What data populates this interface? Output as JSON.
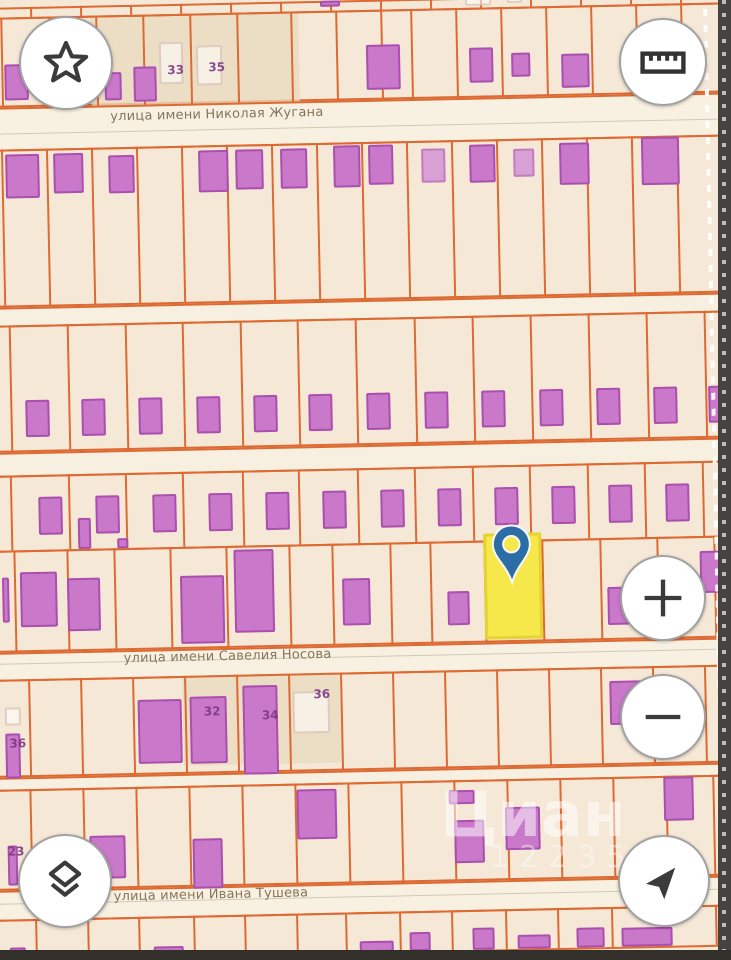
{
  "watermark": {
    "text": "Циан",
    "sub": "12235"
  },
  "controls": {
    "favorites": "star-icon",
    "measure": "ruler-icon",
    "zoom_in": "plus-icon",
    "zoom_out": "minus-icon",
    "layers": "layers-icon",
    "locate": "navigation-arrow-icon"
  },
  "map": {
    "colors": {
      "background": "#f5e8d7",
      "street_band": "#f8f1e2",
      "parcel_line": "#dd6a33",
      "building_fill": "#c978ca",
      "building_outline": "#aa4fae",
      "highlight_fill": "#f6e84b",
      "pin_blue": "#2d6da5",
      "tan_patch": "#e8d9bf"
    },
    "streets": [
      {
        "name": "улица имени Николая Жугана",
        "band_top": 100,
        "band_bottom": 142,
        "label_x": 118,
        "label_y": 104
      },
      {
        "name": "улица имени Савелия Носова",
        "band_top": 645,
        "band_bottom": 672,
        "label_x": 120,
        "label_y": 646
      },
      {
        "name": "улица имени Ивана Тушева",
        "band_top": 883,
        "band_bottom": 912,
        "label_x": 105,
        "label_y": 884
      }
    ],
    "lanes": [
      {
        "top": 300,
        "bottom": 318
      },
      {
        "top": 445,
        "bottom": 468
      },
      {
        "top": 770,
        "bottom": 782
      }
    ],
    "rows": [
      {
        "top": 0,
        "bottom": 10,
        "lines": [
          40,
          90,
          140,
          190,
          240,
          290,
          340,
          390,
          440,
          490,
          540,
          590,
          640,
          690
        ]
      },
      {
        "top": 10,
        "bottom": 100,
        "lines": [
          10,
          58,
          105,
          152,
          199,
          246,
          300,
          345,
          390,
          420,
          465,
          510,
          555,
          600,
          645,
          690
        ]
      },
      {
        "top": 142,
        "bottom": 300,
        "lines": [
          8,
          53,
          98,
          143,
          188,
          233,
          278,
          323,
          368,
          413,
          458,
          503,
          548,
          593,
          638,
          683
        ]
      },
      {
        "top": 318,
        "bottom": 445,
        "lines": [
          12,
          70,
          128,
          185,
          243,
          300,
          358,
          417,
          475,
          533,
          591,
          649,
          707
        ]
      },
      {
        "top": 468,
        "bottom": 543,
        "lines": [
          10,
          68,
          125,
          182,
          242,
          298,
          357,
          414,
          472,
          529,
          587,
          644,
          702
        ]
      },
      {
        "top": 543,
        "bottom": 645,
        "lines": [
          12,
          65,
          112,
          168,
          224,
          287,
          330,
          388,
          428,
          482,
          540,
          598,
          655,
          712
        ]
      },
      {
        "top": 672,
        "bottom": 770,
        "lines": [
          24,
          76,
          128,
          180,
          232,
          284,
          336,
          388,
          440,
          492,
          544,
          596,
          648,
          700
        ]
      },
      {
        "top": 782,
        "bottom": 883,
        "lines": [
          23,
          76,
          129,
          182,
          235,
          288,
          341,
          394,
          447,
          500,
          553,
          606,
          659,
          706
        ]
      },
      {
        "top": 912,
        "bottom": 952,
        "lines": [
          26,
          78,
          129,
          184,
          235,
          287,
          336,
          390,
          442,
          496,
          548,
          602,
          654,
          706
        ]
      }
    ],
    "patches": [
      {
        "x": 100,
        "y": 10,
        "w": 208,
        "h": 90
      },
      {
        "x": 178,
        "y": 672,
        "w": 158,
        "h": 90
      }
    ],
    "buildings": [
      [
        330,
        0,
        20,
        6,
        "s"
      ],
      [
        475,
        0,
        26,
        8,
        "g"
      ],
      [
        517,
        0,
        15,
        6,
        "g"
      ],
      [
        13,
        57,
        24,
        36,
        "s"
      ],
      [
        78,
        52,
        22,
        45,
        "s"
      ],
      [
        113,
        67,
        17,
        28,
        "s"
      ],
      [
        142,
        62,
        23,
        35,
        "s"
      ],
      [
        168,
        38,
        24,
        42,
        "g"
      ],
      [
        205,
        42,
        26,
        40,
        "g"
      ],
      [
        375,
        45,
        34,
        45,
        "s"
      ],
      [
        478,
        50,
        24,
        35,
        "s"
      ],
      [
        520,
        56,
        19,
        24,
        "s"
      ],
      [
        570,
        58,
        28,
        34,
        "s"
      ],
      [
        650,
        42,
        33,
        46,
        "s"
      ],
      [
        12,
        147,
        34,
        44,
        "s"
      ],
      [
        60,
        147,
        30,
        40,
        "s"
      ],
      [
        115,
        150,
        26,
        38,
        "s"
      ],
      [
        205,
        147,
        30,
        42,
        "s"
      ],
      [
        242,
        147,
        28,
        40,
        "s"
      ],
      [
        287,
        147,
        27,
        40,
        "s"
      ],
      [
        340,
        145,
        27,
        42,
        "s"
      ],
      [
        375,
        145,
        25,
        40,
        "s"
      ],
      [
        428,
        150,
        24,
        34,
        "l"
      ],
      [
        476,
        147,
        26,
        38,
        "s"
      ],
      [
        520,
        152,
        21,
        28,
        "l"
      ],
      [
        566,
        147,
        30,
        42,
        "s"
      ],
      [
        648,
        143,
        38,
        48,
        "s"
      ],
      [
        27,
        393,
        24,
        37,
        "s"
      ],
      [
        83,
        393,
        24,
        37,
        "s"
      ],
      [
        140,
        393,
        24,
        37,
        "s"
      ],
      [
        198,
        393,
        24,
        37,
        "s"
      ],
      [
        255,
        393,
        24,
        37,
        "s"
      ],
      [
        310,
        393,
        24,
        37,
        "s"
      ],
      [
        368,
        393,
        24,
        37,
        "s"
      ],
      [
        426,
        393,
        24,
        37,
        "s"
      ],
      [
        483,
        393,
        24,
        37,
        "s"
      ],
      [
        541,
        393,
        24,
        37,
        "s"
      ],
      [
        598,
        393,
        24,
        37,
        "s"
      ],
      [
        655,
        393,
        24,
        37,
        "s"
      ],
      [
        710,
        393,
        16,
        37,
        "s"
      ],
      [
        38,
        490,
        24,
        38,
        "s"
      ],
      [
        95,
        490,
        24,
        38,
        "s"
      ],
      [
        152,
        490,
        24,
        38,
        "s"
      ],
      [
        208,
        490,
        24,
        38,
        "s"
      ],
      [
        265,
        490,
        24,
        38,
        "s"
      ],
      [
        322,
        490,
        24,
        38,
        "s"
      ],
      [
        380,
        490,
        24,
        38,
        "s"
      ],
      [
        437,
        490,
        24,
        38,
        "s"
      ],
      [
        494,
        490,
        24,
        38,
        "s"
      ],
      [
        551,
        490,
        24,
        38,
        "s"
      ],
      [
        608,
        490,
        24,
        38,
        "s"
      ],
      [
        665,
        490,
        24,
        38,
        "s"
      ],
      [
        77,
        512,
        13,
        31,
        "s"
      ],
      [
        116,
        533,
        11,
        10,
        "s"
      ],
      [
        0,
        570,
        7,
        45,
        "s"
      ],
      [
        18,
        565,
        37,
        55,
        "s"
      ],
      [
        65,
        572,
        33,
        53,
        "s"
      ],
      [
        178,
        572,
        44,
        68,
        "s"
      ],
      [
        232,
        547,
        40,
        83,
        "s"
      ],
      [
        340,
        578,
        28,
        47,
        "s"
      ],
      [
        445,
        593,
        22,
        34,
        "s"
      ],
      [
        605,
        592,
        35,
        38,
        "s"
      ],
      [
        698,
        558,
        24,
        42,
        "s"
      ],
      [
        0,
        700,
        16,
        18,
        "g"
      ],
      [
        0,
        726,
        15,
        45,
        "s"
      ],
      [
        133,
        695,
        44,
        64,
        "s"
      ],
      [
        185,
        693,
        37,
        67,
        "s"
      ],
      [
        238,
        683,
        35,
        89,
        "s"
      ],
      [
        288,
        690,
        37,
        42,
        "g"
      ],
      [
        605,
        686,
        37,
        44,
        "s"
      ],
      [
        0,
        838,
        10,
        40,
        "s"
      ],
      [
        38,
        833,
        37,
        40,
        "s"
      ],
      [
        82,
        830,
        36,
        43,
        "s"
      ],
      [
        185,
        835,
        30,
        50,
        "s"
      ],
      [
        290,
        788,
        40,
        50,
        "s"
      ],
      [
        442,
        792,
        26,
        14,
        "s"
      ],
      [
        447,
        822,
        30,
        43,
        "s"
      ],
      [
        498,
        810,
        35,
        43,
        "s"
      ],
      [
        657,
        783,
        30,
        44,
        "s"
      ],
      [
        0,
        940,
        16,
        12,
        "s"
      ],
      [
        144,
        942,
        30,
        10,
        "s"
      ],
      [
        350,
        941,
        34,
        11,
        "s"
      ],
      [
        400,
        933,
        21,
        19,
        "s"
      ],
      [
        463,
        930,
        22,
        22,
        "s"
      ],
      [
        508,
        938,
        33,
        14,
        "s"
      ],
      [
        567,
        932,
        28,
        20,
        "s"
      ],
      [
        612,
        933,
        51,
        19,
        "s"
      ]
    ],
    "house_numbers": [
      {
        "text": "33",
        "x": 176,
        "y": 60
      },
      {
        "text": "35",
        "x": 217,
        "y": 58
      },
      {
        "text": "32",
        "x": 199,
        "y": 702
      },
      {
        "text": "34",
        "x": 257,
        "y": 707
      },
      {
        "text": "36",
        "x": 309,
        "y": 687
      },
      {
        "text": "36",
        "x": 4,
        "y": 730
      },
      {
        "text": "23",
        "x": 0,
        "y": 838
      }
    ],
    "highlight": {
      "x": 482,
      "y": 536,
      "w": 58,
      "h": 106
    },
    "pin": {
      "x": 490,
      "y": 527
    },
    "dashed_boundary_x": 713
  }
}
